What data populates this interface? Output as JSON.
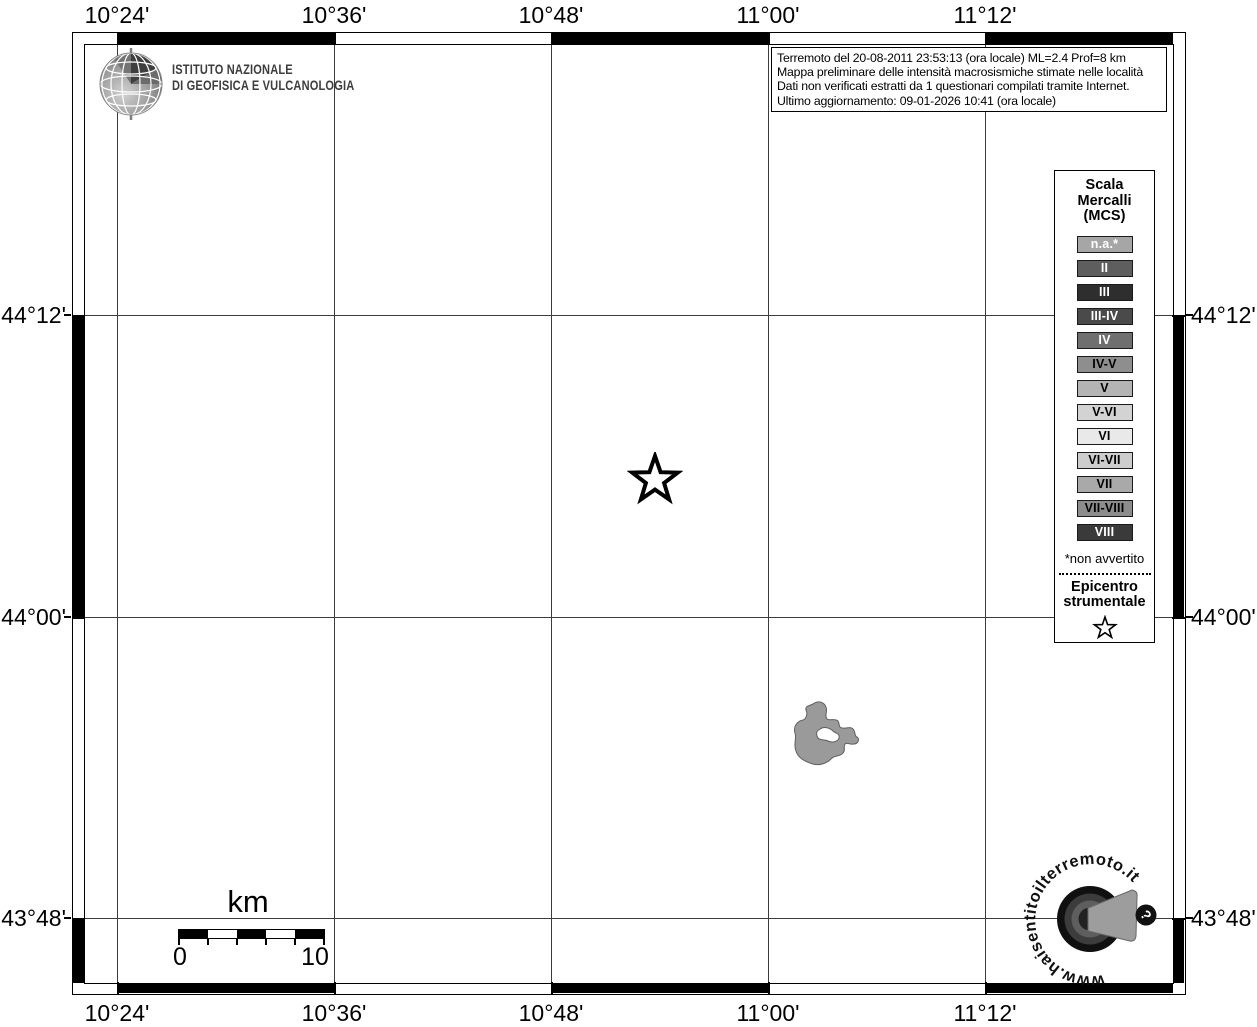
{
  "info_box": {
    "lines": [
      "Terremoto del 20-08-2011 23:53:13 (ora locale) ML=2.4 Prof=8 km",
      "Mappa preliminare delle intensità macrosismiche stimate nelle località",
      "Dati non verificati estratti da 1 questionari compilati tramite Internet.",
      "Ultimo aggiornamento: 09-01-2026 10:41 (ora locale)"
    ]
  },
  "ingv_logo": {
    "line1": "ISTITUTO NAZIONALE",
    "line2": "DI GEOFISICA E VULCANOLOGIA"
  },
  "axes": {
    "lon_labels": [
      "10°24'",
      "10°36'",
      "10°48'",
      "11°00'",
      "11°12'"
    ],
    "lat_labels": [
      "44°12'",
      "44°00'",
      "43°48'"
    ]
  },
  "legend": {
    "title_lines": [
      "Scala",
      "Mercalli",
      "(MCS)"
    ],
    "items": [
      {
        "label": "n.a.*",
        "bg": "#a6a6a6",
        "fg": "#ffffff"
      },
      {
        "label": "II",
        "bg": "#5e5e5e",
        "fg": "#ffffff"
      },
      {
        "label": "III",
        "bg": "#2e2e2e",
        "fg": "#ffffff"
      },
      {
        "label": "III-IV",
        "bg": "#4a4a4a",
        "fg": "#ffffff"
      },
      {
        "label": "IV",
        "bg": "#6f6f6f",
        "fg": "#ffffff"
      },
      {
        "label": "IV-V",
        "bg": "#8e8e8e",
        "fg": "#000000"
      },
      {
        "label": "V",
        "bg": "#b4b4b4",
        "fg": "#000000"
      },
      {
        "label": "V-VI",
        "bg": "#d3d3d3",
        "fg": "#000000"
      },
      {
        "label": "VI",
        "bg": "#e9e9e9",
        "fg": "#000000"
      },
      {
        "label": "VI-VII",
        "bg": "#cdcdcd",
        "fg": "#000000"
      },
      {
        "label": "VII",
        "bg": "#a9a9a9",
        "fg": "#000000"
      },
      {
        "label": "VII-VIII",
        "bg": "#8c8c8c",
        "fg": "#000000"
      },
      {
        "label": "VIII",
        "bg": "#3a3a3a",
        "fg": "#ffffff"
      }
    ],
    "footnote": "*non avvertito",
    "epicenter_lines": [
      "Epicentro",
      "strumentale"
    ]
  },
  "scalebar": {
    "unit_label": "km",
    "start_label": "0",
    "end_label": "10"
  },
  "footer_logo": {
    "url_text": "www.haisentitoilterremoto.it",
    "question_mark": "?"
  }
}
